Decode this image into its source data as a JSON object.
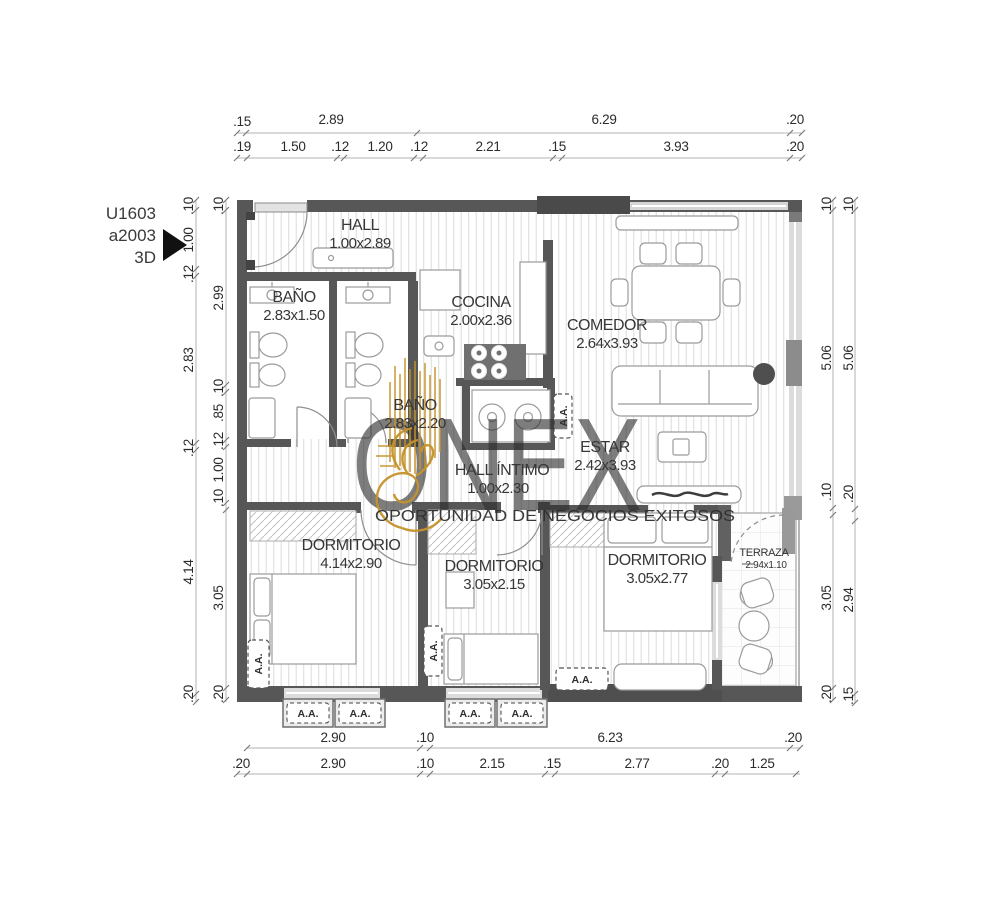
{
  "unit": {
    "line1": "U1603",
    "line2": "a2003",
    "line3": "3D"
  },
  "labels": {
    "aa": "A.A."
  },
  "watermark": {
    "brand": "ONEX",
    "tagline": "OPORTUNIDAD DE NEGOCIOS EXITOSOS",
    "gold": "#c6932b",
    "gray": "#454545"
  },
  "colors": {
    "wall": "#575757",
    "hatch": "#dedede",
    "dim_text": "#2b2b2b"
  },
  "rooms": {
    "hall": {
      "name": "HALL",
      "size": "1.00x2.89"
    },
    "bano1": {
      "name": "BAÑO",
      "size": "2.83x1.50"
    },
    "bano2": {
      "name": "BAÑO",
      "size": "2.83x2.20"
    },
    "cocina": {
      "name": "COCINA",
      "size": "2.00x2.36"
    },
    "comedor": {
      "name": "COMEDOR",
      "size": "2.64x3.93"
    },
    "estar": {
      "name": "ESTAR",
      "size": "2.42x3.93"
    },
    "hall_intimo": {
      "name": "HALL ÍNTIMO",
      "size": "1.00x2.30"
    },
    "dorm1": {
      "name": "DORMITORIO",
      "size": "4.14x2.90"
    },
    "dorm2": {
      "name": "DORMITORIO",
      "size": "3.05x2.15"
    },
    "dorm3": {
      "name": "DORMITORIO",
      "size": "3.05x2.77"
    },
    "terraza": {
      "name": "TERRAZA",
      "size": "2.94x1.10"
    }
  },
  "dims": {
    "top1": [
      ".15",
      "2.89",
      "6.29",
      ".20"
    ],
    "top2": [
      ".19",
      "1.50",
      ".12",
      "1.20",
      ".12",
      "2.21",
      ".15",
      "3.93",
      ".20"
    ],
    "bottom1": [
      "2.90",
      ".10",
      "6.23",
      ".20"
    ],
    "bottom2": [
      ".20",
      "2.90",
      ".10",
      "2.15",
      ".15",
      "2.77",
      ".20",
      "1.25"
    ],
    "left_outer": [
      ".10",
      "1.00",
      ".12",
      "2.83",
      ".12",
      "4.14",
      ".20"
    ],
    "left_inner": [
      ".10",
      "2.99",
      ".10",
      ".85",
      ".12",
      "1.00",
      ".10",
      "3.05",
      ".20"
    ],
    "right_inner": [
      ".10",
      "5.06",
      ".10",
      "3.05",
      ".20"
    ],
    "right_outer": [
      ".10",
      "5.06",
      ".20",
      "2.94",
      ".15"
    ]
  }
}
